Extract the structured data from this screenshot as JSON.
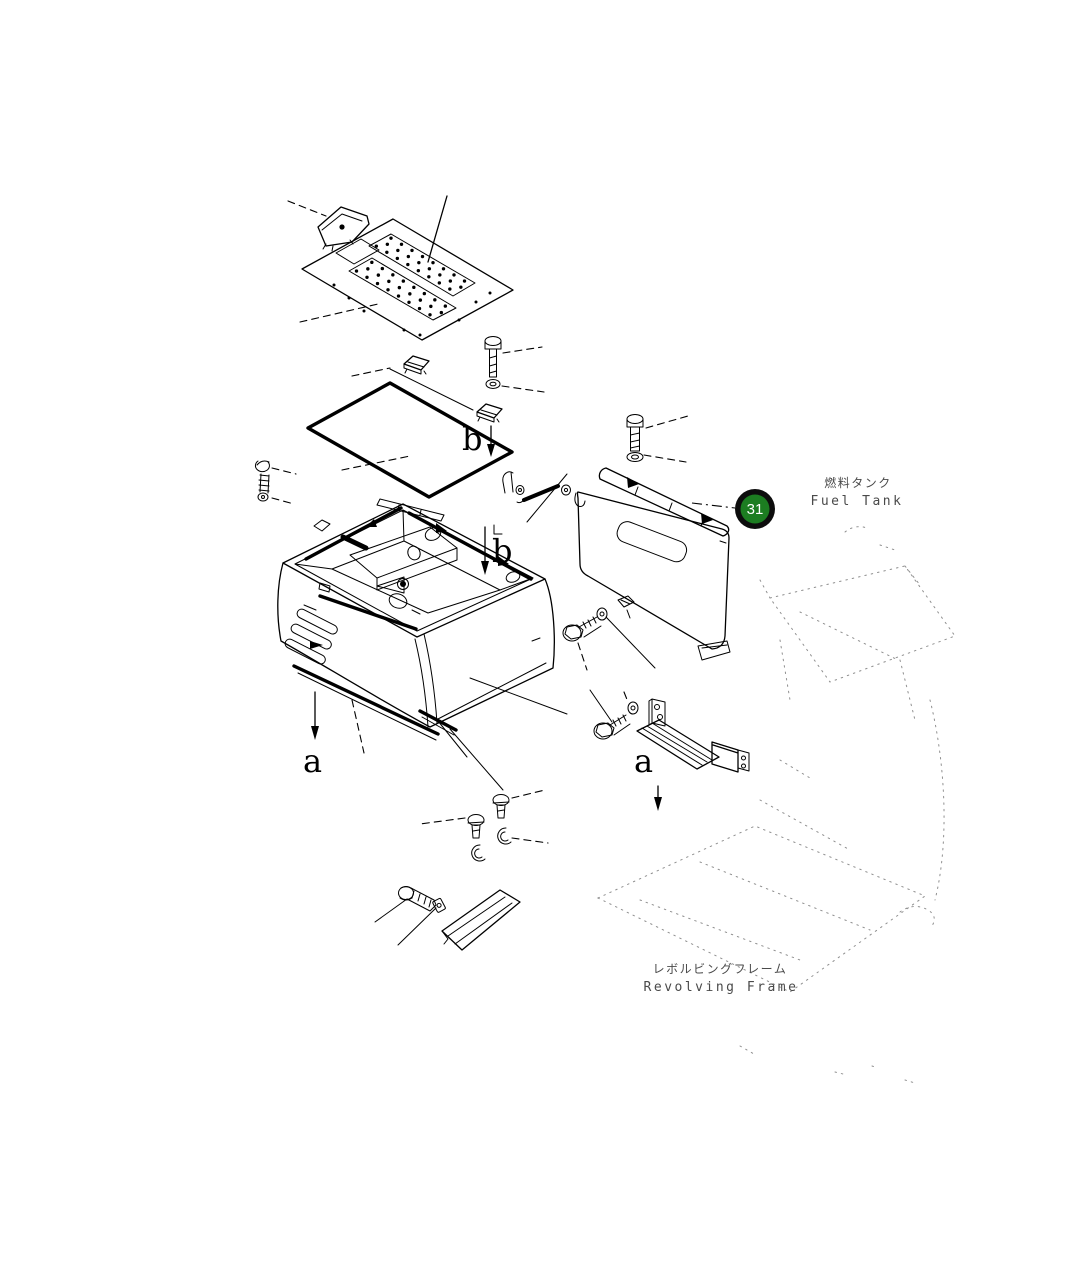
{
  "diagram": {
    "badge": {
      "number": "31"
    },
    "labels": {
      "fuel_tank_jp": "燃料タンク",
      "fuel_tank_en": "Fuel Tank",
      "revolving_frame_jp": "レボルビングフレーム",
      "revolving_frame_en": "Revolving Frame",
      "view_b_top": "b",
      "view_b_inner": "b",
      "view_a_left": "a",
      "view_a_right": "a"
    },
    "colors": {
      "badge_fill": "#1c7d21",
      "badge_ring": "#0d0d0d",
      "badge_text": "#ffffff",
      "line": "#000000",
      "phantom": "#8f8f8f",
      "background": "#ffffff"
    }
  }
}
